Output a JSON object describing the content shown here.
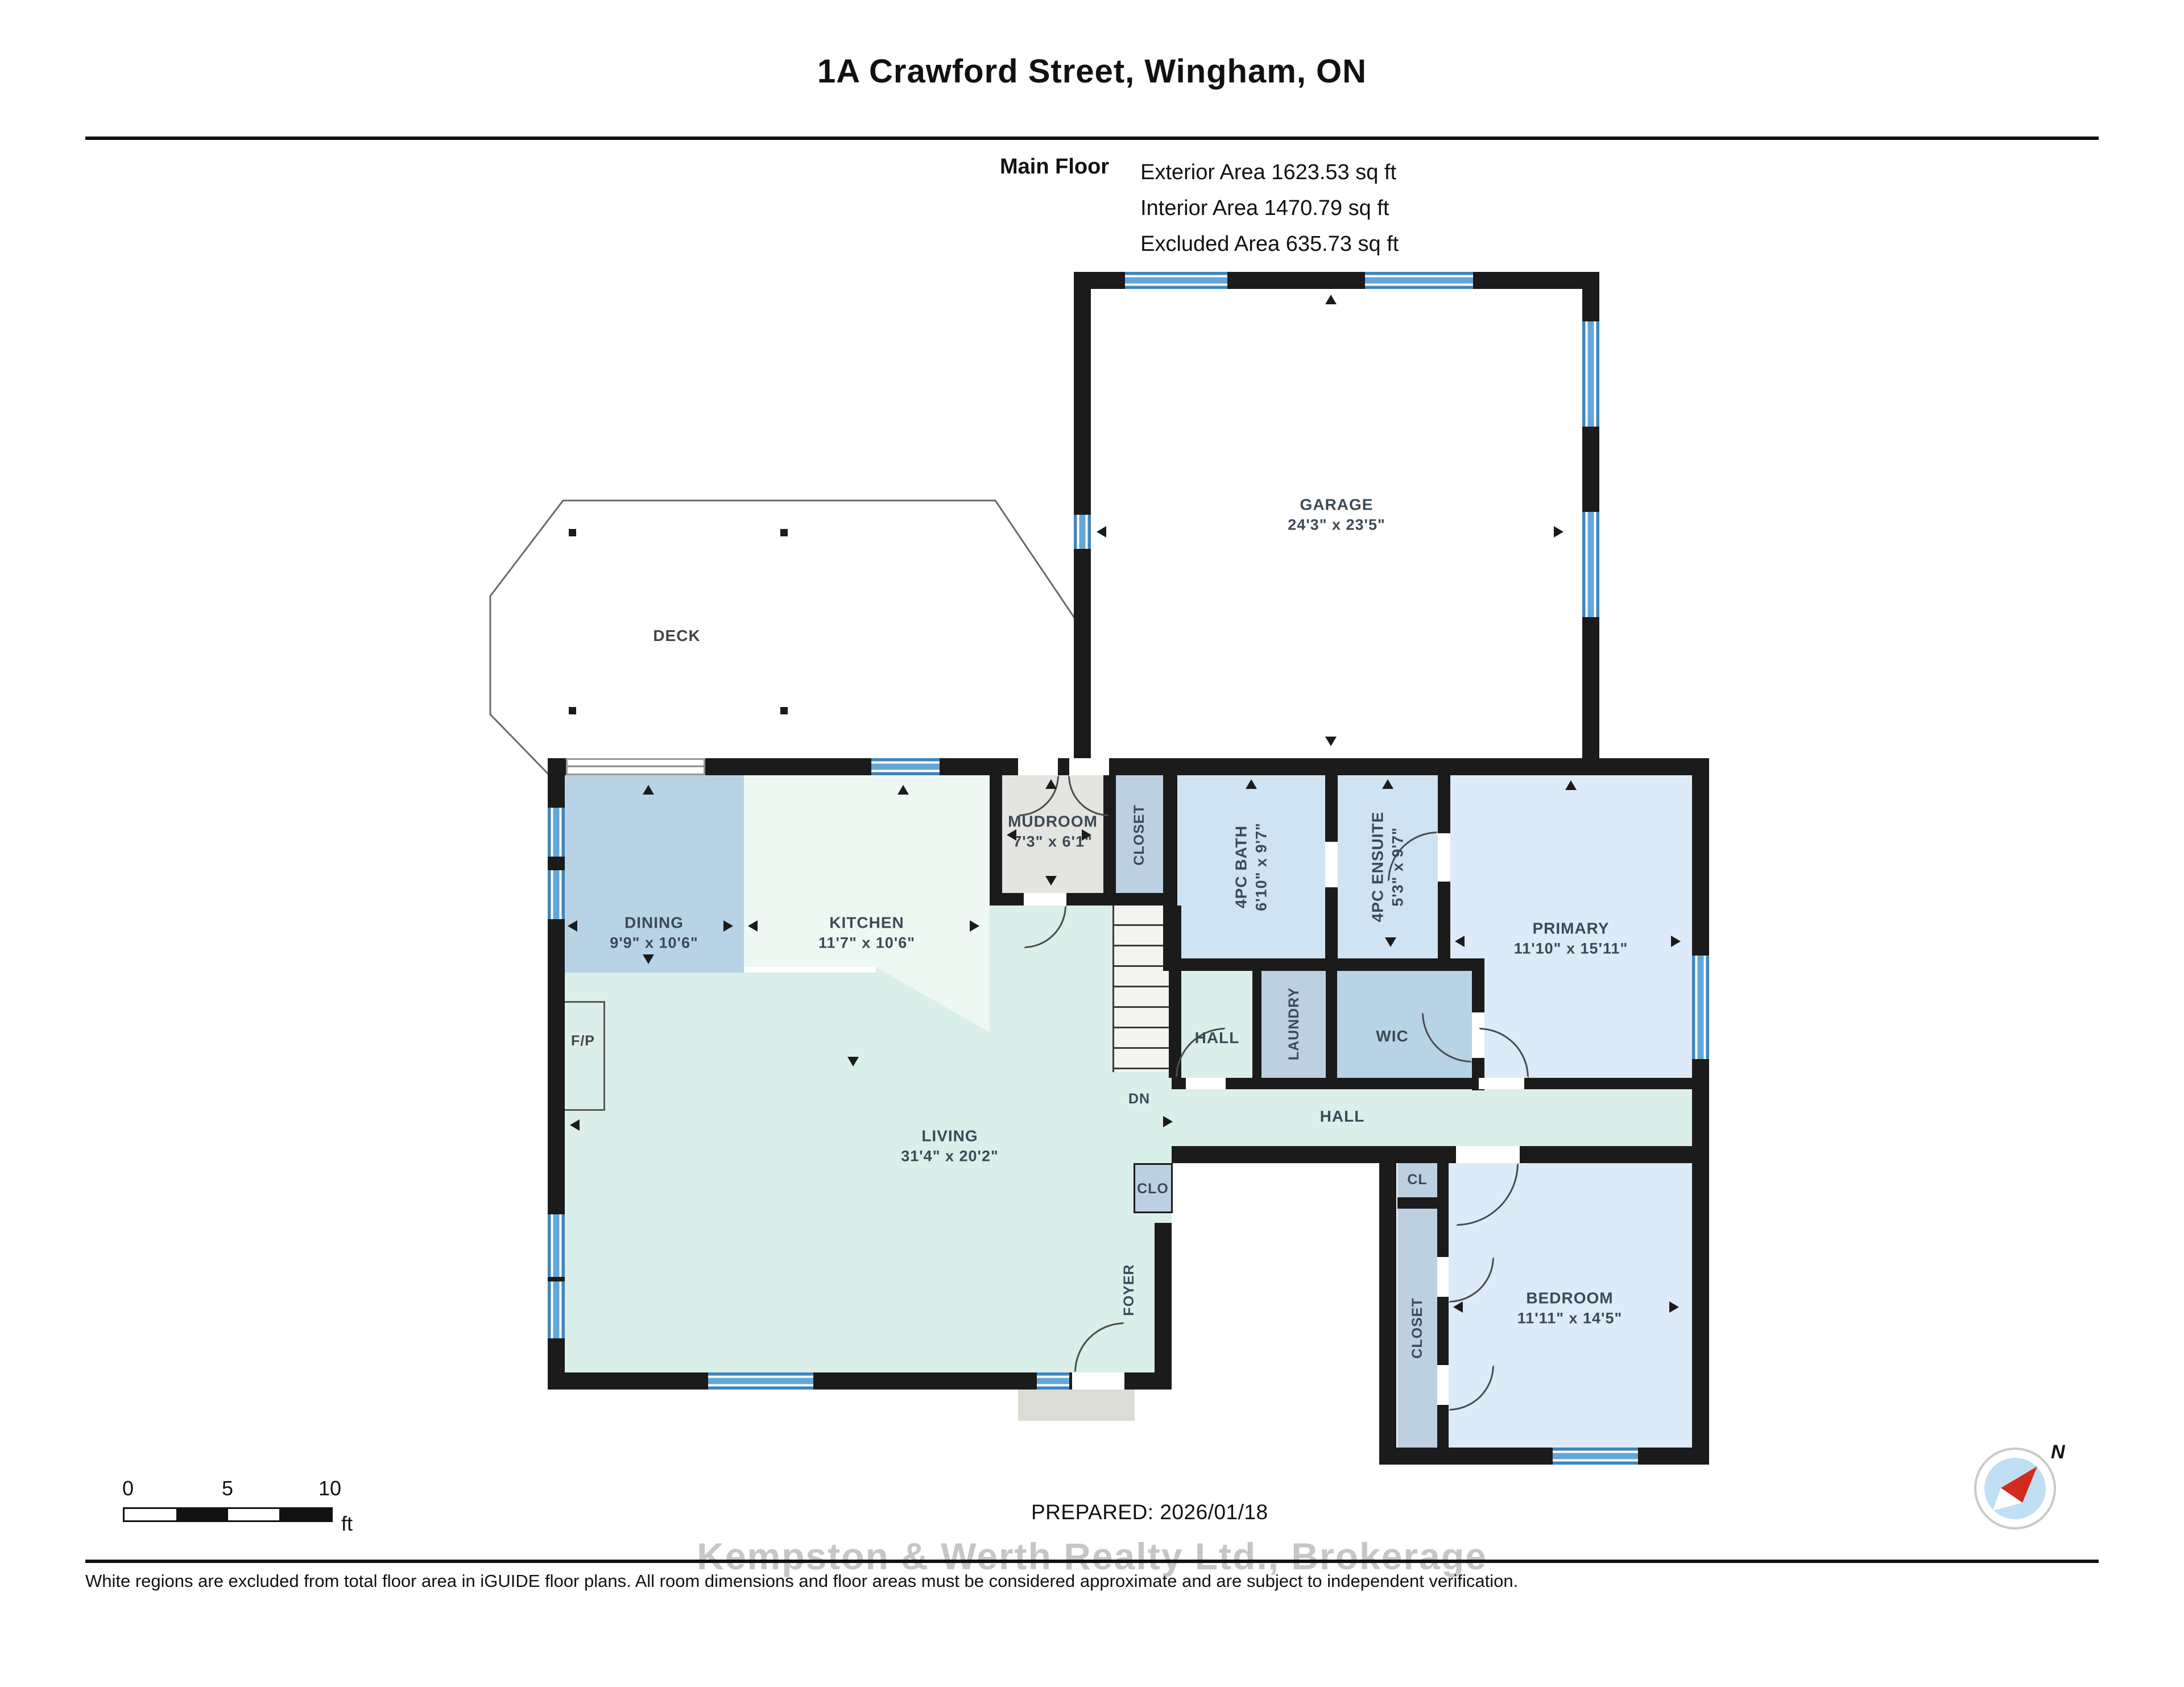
{
  "title": "1A Crawford Street, Wingham, ON",
  "floor_info": {
    "name": "Main Floor",
    "exterior": "Exterior Area 1623.53 sq ft",
    "interior": "Interior Area 1470.79 sq ft",
    "excluded": "Excluded Area 635.73 sq ft"
  },
  "rooms": {
    "garage": {
      "name": "GARAGE",
      "dims": "24'3\" x 23'5\""
    },
    "deck": {
      "name": "DECK"
    },
    "dining": {
      "name": "DINING",
      "dims": "9'9\" x 10'6\""
    },
    "kitchen": {
      "name": "KITCHEN",
      "dims": "11'7\" x 10'6\""
    },
    "mudroom": {
      "name": "MUDROOM",
      "dims": "7'3\" x 6'1\""
    },
    "mud_closet": {
      "name": "CLOSET"
    },
    "bath": {
      "name": "4PC BATH",
      "dims": "6'10\" x 9'7\""
    },
    "ensuite": {
      "name": "4PC ENSUITE",
      "dims": "5'3\" x 9'7\""
    },
    "primary": {
      "name": "PRIMARY",
      "dims": "11'10\" x 15'11\""
    },
    "hall_upper": {
      "name": "HALL"
    },
    "laundry": {
      "name": "LAUNDRY"
    },
    "wic": {
      "name": "WIC"
    },
    "hall": {
      "name": "HALL"
    },
    "living": {
      "name": "LIVING",
      "dims": "31'4\" x 20'2\""
    },
    "fireplace": {
      "name": "F/P"
    },
    "stairs": {
      "name": "DN"
    },
    "clo": {
      "name": "CLO"
    },
    "foyer": {
      "name": "FOYER"
    },
    "cl": {
      "name": "CL"
    },
    "bed_closet": {
      "name": "CLOSET"
    },
    "bedroom": {
      "name": "BEDROOM",
      "dims": "11'11\" x 14'5\""
    }
  },
  "scale_bar": {
    "ticks": [
      "0",
      "5",
      "10"
    ],
    "unit": "ft"
  },
  "compass": {
    "label": "N"
  },
  "footer": {
    "prepared": "PREPARED: 2026/01/18",
    "watermark": "Kempston & Werth Realty Ltd., Brokerage",
    "disclaimer": "White regions are excluded from total floor area in iGUIDE floor plans. All room dimensions and floor areas must be considered approximate and are subject to independent verification."
  },
  "colors": {
    "wall": "#1b1b1b",
    "window_blue": "#4f97cf",
    "room_pale_blue": "#dcebf7",
    "room_medium_blue": "#b9d3e6",
    "room_teal": "#daeeea",
    "room_mint": "#edf8f3",
    "room_gray": "#e4e4e0",
    "room_grayblue": "#bcd0e2"
  }
}
